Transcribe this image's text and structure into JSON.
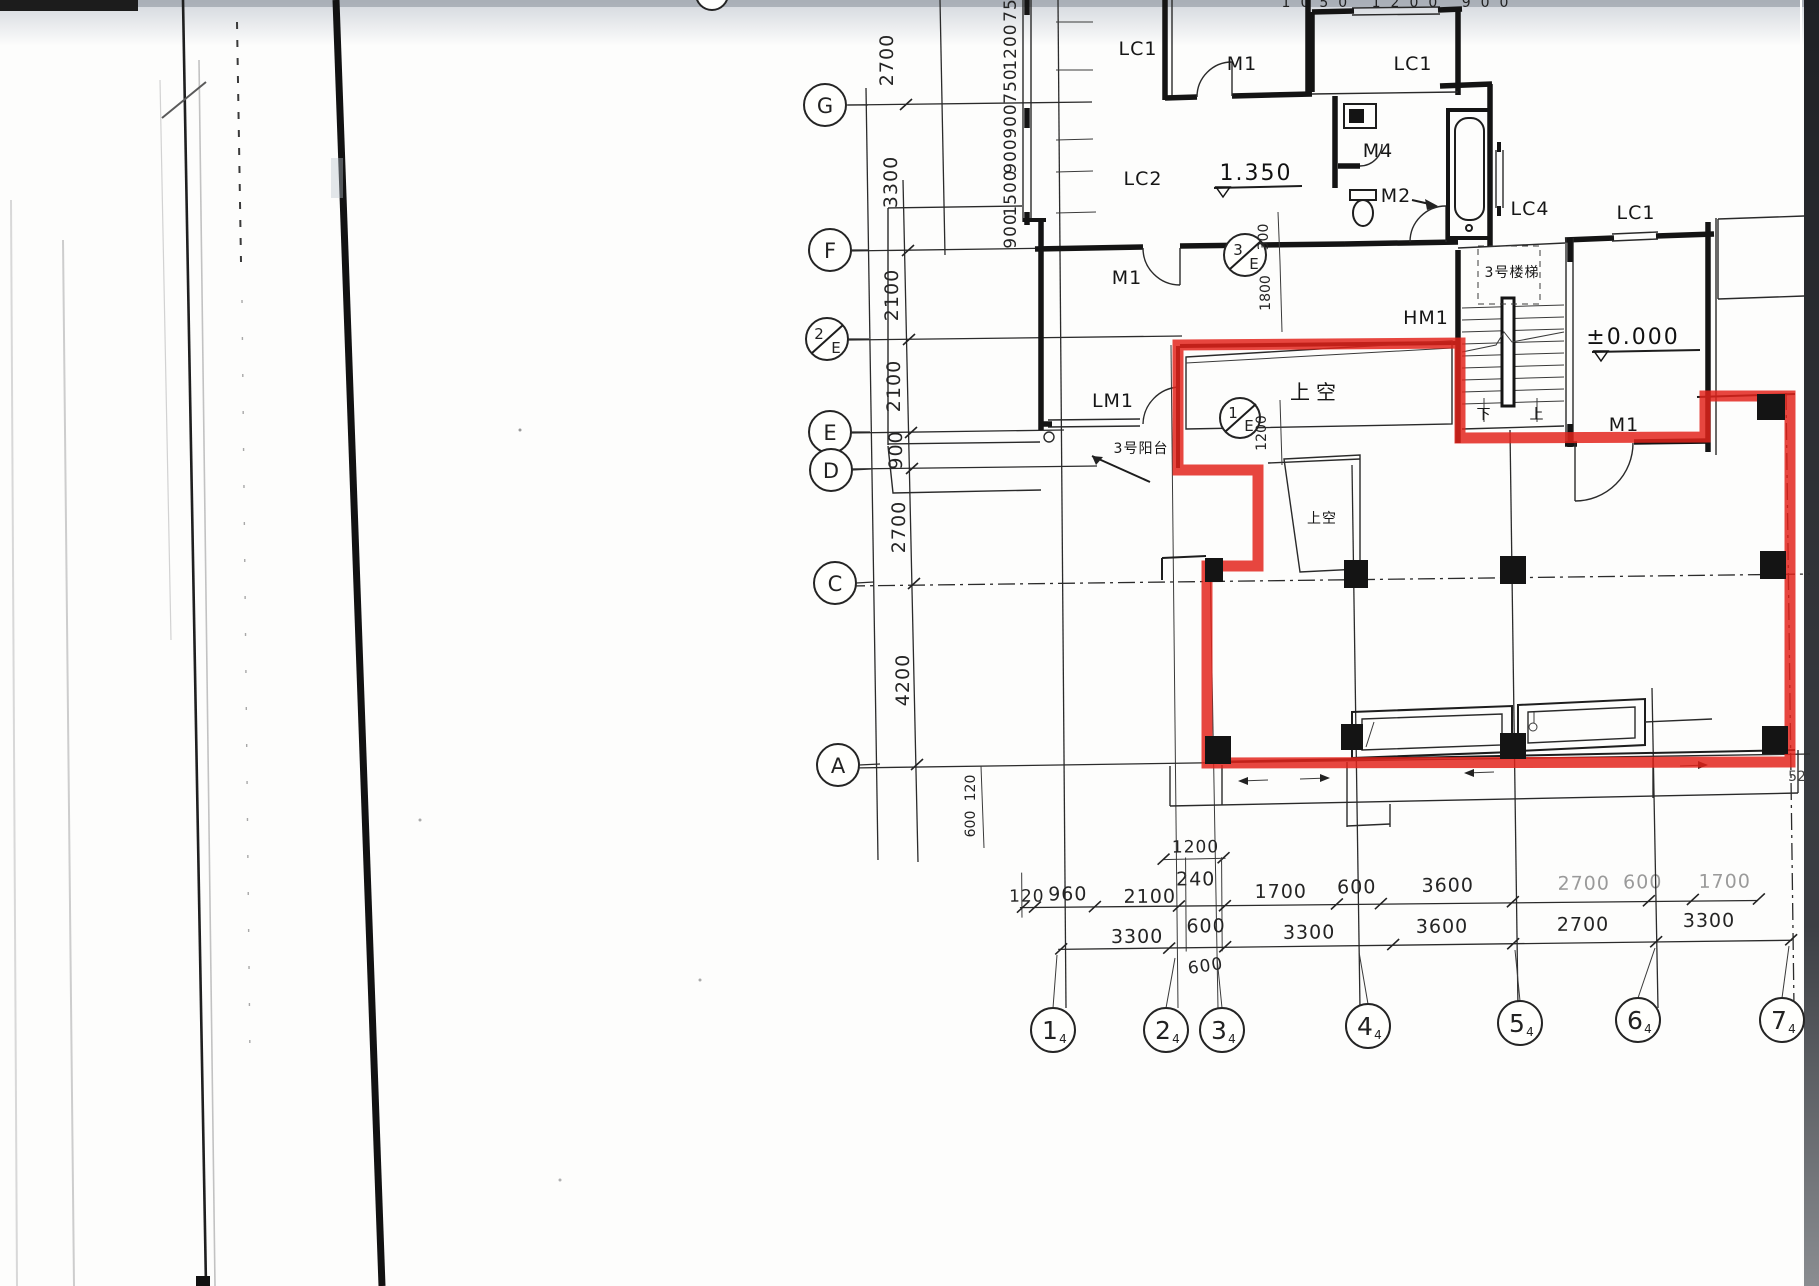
{
  "meta": {
    "description": "Scanned architectural floor plan sheet; one dwelling unit outlined with red highlighter"
  },
  "colors": {
    "highlight_red": "#e2221a",
    "ink": "#141414",
    "paper": "#fdfdfc",
    "scan_edge_dark": "#2e3136"
  },
  "axes": {
    "rows": [
      {
        "label": "G"
      },
      {
        "label": "F"
      },
      {
        "label": "2/E",
        "num": "2",
        "den": "E"
      },
      {
        "label": "E"
      },
      {
        "label": "D"
      },
      {
        "label": "C"
      },
      {
        "label": "A"
      }
    ],
    "cols": [
      {
        "label": "1",
        "sub": "4"
      },
      {
        "label": "2",
        "sub": "4"
      },
      {
        "label": "3",
        "sub": "4"
      },
      {
        "label": "4",
        "sub": "4"
      },
      {
        "label": "5",
        "sub": "4"
      },
      {
        "label": "6",
        "sub": "4"
      },
      {
        "label": "7",
        "sub": "4"
      }
    ],
    "intersections": [
      {
        "num": "3",
        "den": "E"
      },
      {
        "num": "1",
        "den": "E"
      }
    ]
  },
  "dims": {
    "left_main": [
      "2700",
      "3300",
      "2100",
      "2100",
      "900",
      "2700",
      "4200"
    ],
    "left_sub": [
      "75",
      "1200",
      "750",
      "900",
      "900",
      "1500",
      "900"
    ],
    "below_a": [
      "120",
      "600"
    ],
    "stair_sub": [
      "300",
      "1800",
      "1200"
    ],
    "top_cut": "1050 1200 900",
    "bottom_small_upper": [
      "1200",
      "240"
    ],
    "bottom_row1": [
      "120",
      "960",
      "2100",
      "1700",
      "600",
      "3600",
      "2700",
      "600",
      "1700"
    ],
    "bottom_row2": [
      "3300",
      "600",
      "3300",
      "3600",
      "2700",
      "3300"
    ],
    "bottom_below": "600",
    "right_edge_cut": "52"
  },
  "openings": {
    "lc1_top": "LC1",
    "m1_top": "M1",
    "lc1_topright": "LC1",
    "lc2": "LC2",
    "m4": "M4",
    "m2": "M2",
    "lc4": "LC4",
    "lc1_right": "LC1",
    "m1_mid": "M1",
    "lm1": "LM1",
    "hm1": "HM1",
    "m1_entry": "M1"
  },
  "levels": {
    "upper": "1.350",
    "ground": "±0.000"
  },
  "annotations": {
    "void_1": "上空",
    "void_2": "上空",
    "stair": "3号楼梯",
    "balcony": "3号阳台",
    "down": "下",
    "up": "上"
  }
}
